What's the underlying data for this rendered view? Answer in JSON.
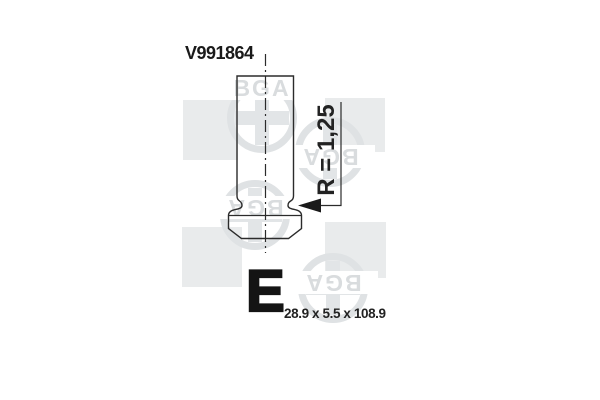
{
  "part": {
    "number": "V991864",
    "type_code": "E",
    "dimensions": "28.9 x 5.5 x 108.9",
    "radius": "R = 1,25"
  },
  "brand": {
    "name": "BGA"
  },
  "drawing": {
    "kind": "engine-valve-profile",
    "features": [
      "stem",
      "neck-groove",
      "head",
      "chamfered-seat",
      "dash-dot-centerline",
      "radius-callout-arrow"
    ]
  },
  "colors": {
    "background": "#ffffff",
    "line": "#2b2b2b",
    "text": "#1a1a1a",
    "watermark_shape": "#e9ebec",
    "watermark_ink": "#dfe2e4"
  }
}
